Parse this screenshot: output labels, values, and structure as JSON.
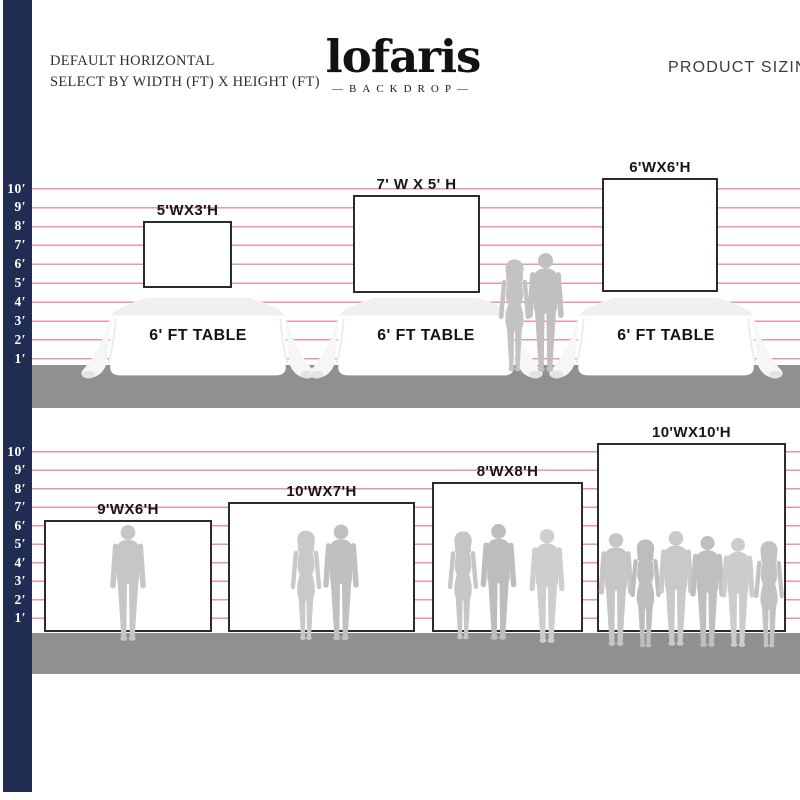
{
  "header": {
    "mode_line1": "DEFAULT HORIZONTAL",
    "mode_line2": "SELECT BY WIDTH (FT) X HEIGHT (FT)",
    "title": "PRODUCT SIZING"
  },
  "brand": {
    "name": "lofaris",
    "tagline": "—BACKDROP—"
  },
  "ruler_ticks": [
    "10′",
    "9′",
    "8′",
    "7′",
    "6′",
    "5′",
    "4′",
    "3′",
    "2′",
    "1′"
  ],
  "row1": {
    "table_label": "6' FT TABLE",
    "backdrops": [
      {
        "label": "5'WX3'H",
        "width_ft": 5,
        "height_ft": 3
      },
      {
        "label": "7' W X 5' H",
        "width_ft": 7,
        "height_ft": 5
      },
      {
        "label": "6'WX6'H",
        "width_ft": 6,
        "height_ft": 6
      }
    ]
  },
  "row2": {
    "backdrops": [
      {
        "label": "9'WX6'H",
        "width_ft": 9,
        "height_ft": 6
      },
      {
        "label": "10'WX7'H",
        "width_ft": 10,
        "height_ft": 7
      },
      {
        "label": "8'WX8'H",
        "width_ft": 8,
        "height_ft": 8
      },
      {
        "label": "10'WX10'H",
        "width_ft": 10,
        "height_ft": 10
      }
    ]
  },
  "colors": {
    "navy_bar": "#202c52",
    "grid_line_pink": "#f093a7",
    "ground_gray": "#909090",
    "silhouette_gray": "#c4c4c4",
    "backdrop_border": "#2b2b2b"
  }
}
